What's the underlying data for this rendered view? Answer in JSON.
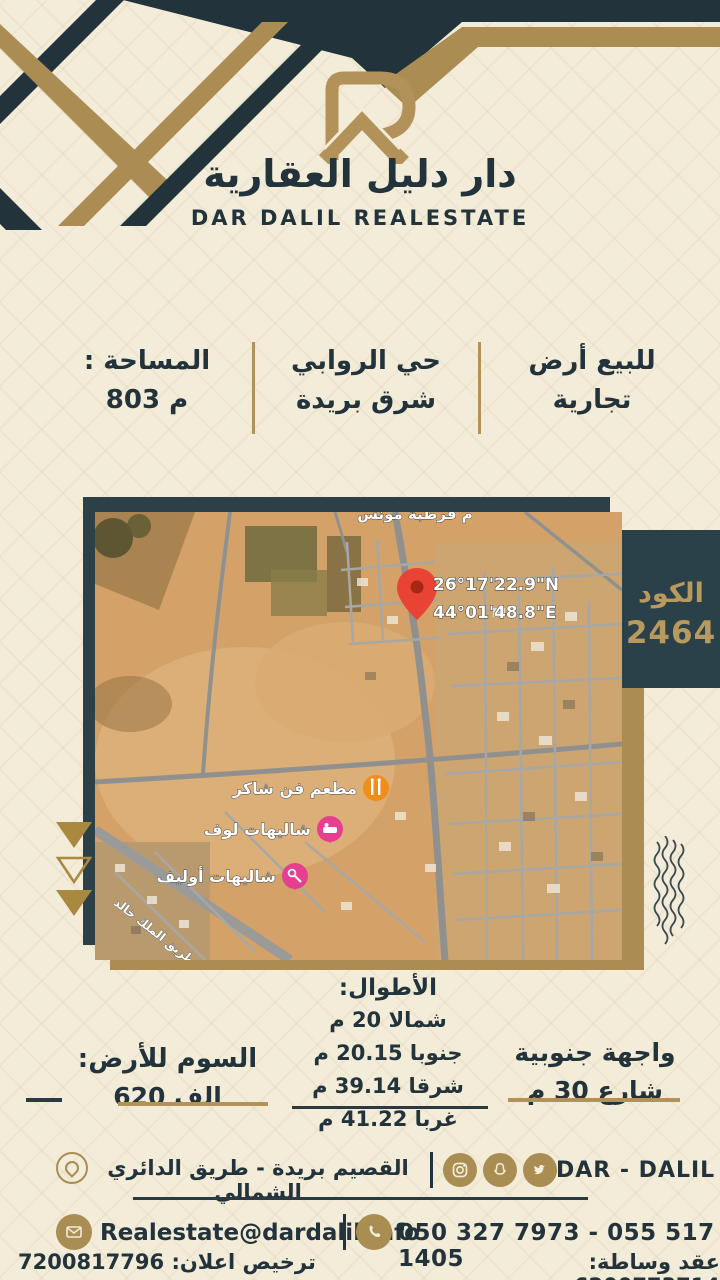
{
  "brand": {
    "title_ar": "دار دليل العقارية",
    "title_en": "DAR DALIL REALESTATE",
    "footer_name": "DAR - DALIL"
  },
  "listing": {
    "type_line1": "للبيع أرض",
    "type_line2": "تجارية",
    "district_line1": "حي الروابي",
    "district_line2": "شرق بريدة",
    "area_label": "المساحة :",
    "area_value": "803 م",
    "code_label": "الكود",
    "code_value": "2464"
  },
  "map": {
    "coord_n": "26°17'22.9\"N",
    "coord_e": "44°01'48.8\"E",
    "top_label": "م قرطبة مونس",
    "poi_restaurant": "مطعم فن شاكر",
    "poi_chalet1": "شاليهات لوف",
    "poi_chalet2": "شاليهات أوليف",
    "street_label": "طريق الملك خالد"
  },
  "details": {
    "lengths_title": "الأطوال:",
    "length_north": "شمالا 20 م",
    "length_south": "جنوبا 20.15 م",
    "length_east": "شرقا 39.14 م",
    "length_west": "غربا 41.22 م",
    "price_label": "السوم للأرض:",
    "price_value": "620 الف",
    "facade_line1": "واجهة جنوبية",
    "facade_line2": "شارع 30 م"
  },
  "footer": {
    "address": "القصيم بريدة - طريق الدائري الشمالي",
    "email": "Realestate@dardalil.info",
    "phones": "050 327 7973 - 055 517 1405",
    "license_label": "ترخيص اعلان:",
    "license_value": "7200817796",
    "contract_label": "عقد وساطة:",
    "contract_value": "6200773714"
  },
  "colors": {
    "navy": "#22333c",
    "gold": "#ab8c52",
    "cream": "#f3ecd9",
    "pin_red": "#e94335",
    "poi_orange": "#ef8e1b",
    "poi_pink": "#e5408f"
  }
}
